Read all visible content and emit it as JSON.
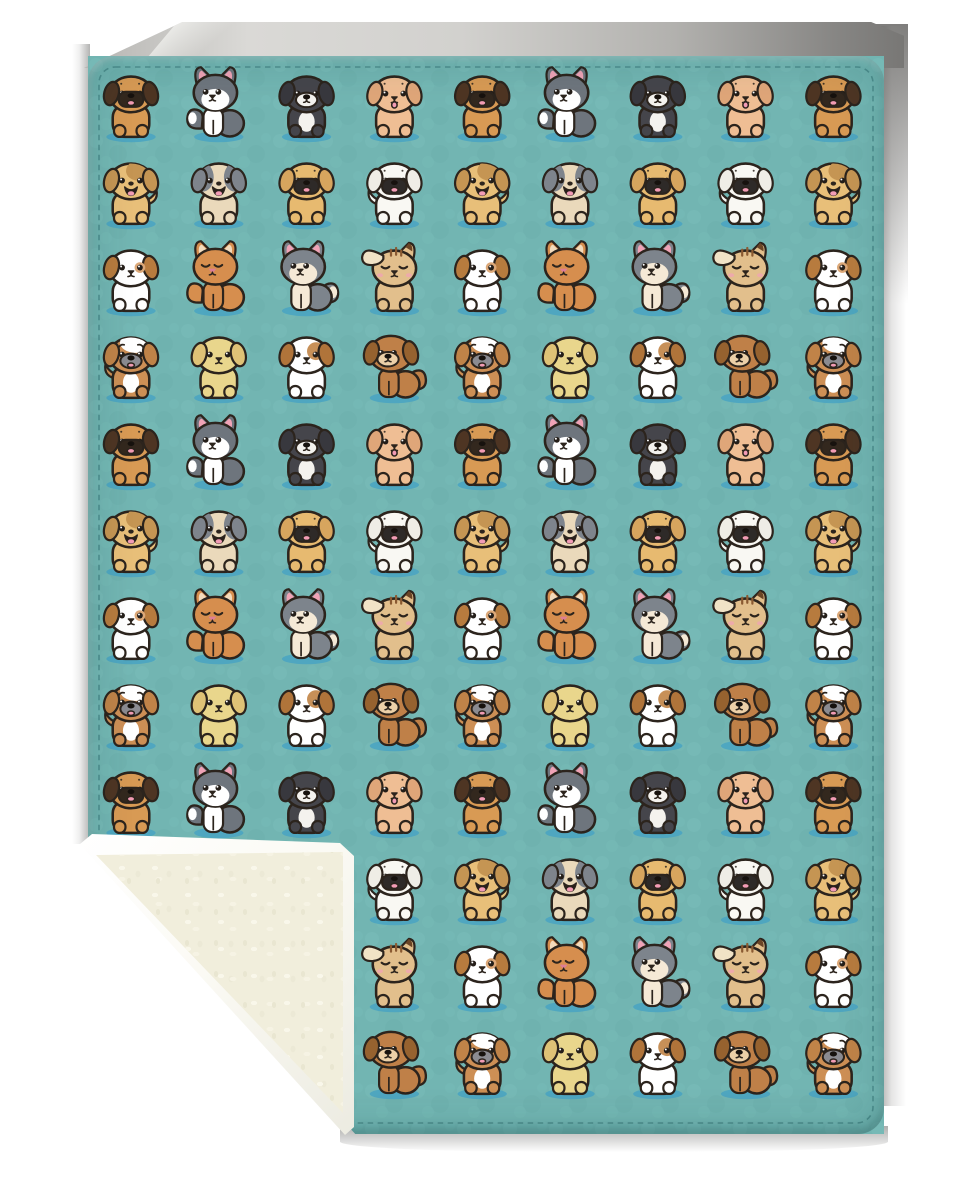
{
  "scene": {
    "type": "product-photo-mockup",
    "subject": "Teal sherpa fleece blanket covered in rows of cute cartoon puppies, bottom-left corner folded up to show the cream sherpa back",
    "front_fabric": "teal minky printed with kawaii puppy pattern",
    "back_fabric": "cream sherpa fleece with white edge binding",
    "background": "white studio backdrop with soft gray shadows"
  },
  "colors": {
    "outline": "#2c241d",
    "blanket_teal": "#72b5b2",
    "teal_light": "#7ec1bd",
    "teal_dark": "#66aaa7",
    "spot_shadow": "#46a2c3",
    "stitch": "#2e6b6e",
    "sherpa_cream": "#f1eedc",
    "binding_white": "#fdfdfb",
    "backdrop_light": "#d8d7d4",
    "backdrop_mid": "#b3b2af",
    "backdrop_dark": "#7b7a78",
    "tongue_pink": "#f29cb5",
    "ear_pink": "#f0a3b6"
  },
  "pattern": {
    "columns": 9,
    "rows": 12,
    "row_cycle": [
      "A",
      "B",
      "C",
      "D"
    ],
    "type_sequences": {
      "A": [
        "pug-brown",
        "husky-gray",
        "puppy-black",
        "puppy-cream"
      ],
      "B": [
        "patch-smile",
        "sheepdog",
        "pug-tan",
        "pug-white"
      ],
      "C": [
        "jack-russell",
        "kitten-orange",
        "husky-kitten",
        "chihuahua-tan"
      ],
      "D": [
        "bulldog",
        "lab-yellow",
        "spotted-white",
        "puppy-brown-sit"
      ]
    }
  },
  "dog_types": {
    "pug-brown": {
      "label": "brown pug puppy",
      "pose": "front",
      "tail": null,
      "body": "#d89a54",
      "ear": {
        "style": "floppy",
        "color": "#4e3523"
      },
      "muzzle": {
        "style": "mask",
        "color": "#33281e",
        "tongue": true
      },
      "eyes": "open",
      "brows": "dots"
    },
    "husky-gray": {
      "label": "gray husky puppy sitting sideways",
      "pose": "side",
      "tail": "left",
      "tail_tip": "#ffffff",
      "body": "#6e757d",
      "leg_color": "#ffffff",
      "ear": {
        "style": "pointy",
        "color": "#6e757d",
        "inner": "#f0a3b6"
      },
      "blaze": "#ffffff",
      "muzzle": {
        "style": "simple",
        "tongue": false
      },
      "eyes": "open",
      "brows": "none"
    },
    "puppy-black": {
      "label": "black puppy with white muzzle",
      "pose": "front",
      "tail": null,
      "body": "#45454b",
      "ear": {
        "style": "floppy",
        "color": "#38383e"
      },
      "chest": "#f4f2ee",
      "muzzle": {
        "style": "oval",
        "color": "#f4f2ee",
        "tongue": false
      },
      "eyes": "open",
      "brows": "none"
    },
    "puppy-cream": {
      "label": "cream puppy with tongue out",
      "pose": "front",
      "tail": null,
      "body": "#efbe94",
      "ear": {
        "style": "floppy",
        "color": "#dfa679"
      },
      "muzzle": {
        "style": "simple",
        "tongue": true
      },
      "eyes": "open",
      "brows": "dots"
    },
    "patch-smile": {
      "label": "tan puppy with brown patch smiling",
      "pose": "front",
      "tail": "right",
      "body": "#e8bf79",
      "ear": {
        "style": "floppy",
        "color": "#c59553"
      },
      "head_patch": {
        "style": "crown-right",
        "color": "#c59553"
      },
      "muzzle": {
        "style": "open",
        "color": "#2a1f1a",
        "tongue": true
      },
      "eyes": "open",
      "brows": "none"
    },
    "sheepdog": {
      "label": "cream puppy with gray ears",
      "pose": "front",
      "tail": null,
      "body": "#ead9bb",
      "ear": {
        "style": "floppy",
        "color": "#7e848c"
      },
      "head_patch": {
        "style": "side-patches",
        "color": "#7e848c"
      },
      "muzzle": {
        "style": "open",
        "color": "#2a1f1a",
        "tongue": true
      },
      "eyes": "open",
      "brows": "none"
    },
    "pug-tan": {
      "label": "tan pug puppy",
      "pose": "front",
      "tail": null,
      "body": "#e7ba70",
      "ear": {
        "style": "floppy",
        "color": "#d7a55e"
      },
      "muzzle": {
        "style": "mask",
        "color": "#2e2a28",
        "tongue": true
      },
      "eyes": "open",
      "brows": "dots"
    },
    "pug-white": {
      "label": "white pug puppy",
      "pose": "front",
      "tail": "left",
      "body": "#f9f8f3",
      "ear": {
        "style": "floppy",
        "color": "#efede6"
      },
      "muzzle": {
        "style": "mask",
        "color": "#2e2a28",
        "tongue": true
      },
      "eyes": "open",
      "brows": "dots"
    },
    "jack-russell": {
      "label": "white puppy with brown ears",
      "pose": "front",
      "tail": null,
      "body": "#ffffff",
      "ear": {
        "style": "floppy",
        "color": "#b77b3e"
      },
      "eye_ring": "#dca878",
      "muzzle": {
        "style": "simple",
        "tongue": false
      },
      "eyes": "open",
      "brows": "none"
    },
    "kitten-orange": {
      "label": "sleepy orange puppy with curled tail",
      "pose": "side",
      "tail": "left",
      "body": "#d68e4e",
      "ear": {
        "style": "pointy",
        "color": "#d68e4e",
        "inner": "#f3dbbc"
      },
      "muzzle": {
        "style": "simple",
        "nose": "#dd7e95",
        "tongue": false
      },
      "eyes": "closed",
      "brows": "none"
    },
    "husky-kitten": {
      "label": "gray puppy with white-tipped tail",
      "pose": "side",
      "tail": "right",
      "tail_tip": "#f5e9d6",
      "body": "#7d848c",
      "leg_color": "#f5e9d6",
      "ear": {
        "style": "pointy",
        "color": "#7d848c",
        "inner": "#f0a3b6"
      },
      "blaze": "#f5e9d6",
      "muzzle": {
        "style": "simple",
        "tongue": false
      },
      "eyes": "open",
      "brows": "none"
    },
    "chihuahua-tan": {
      "label": "sleepy tan chihuahua with blush",
      "pose": "front",
      "tail": null,
      "body": "#e2bf8c",
      "ear": {
        "style": "chihuahua",
        "color": "#f1e3c6",
        "tip": "#6b4526"
      },
      "stripes": "#8a5a32",
      "muzzle": {
        "style": "simple",
        "tongue": false
      },
      "eyes": "closed",
      "blush": "#f0a3b6",
      "brows": "none"
    },
    "bulldog": {
      "label": "worried bulldog puppy",
      "pose": "front",
      "tail": "left",
      "body": "#cd8f55",
      "ear": {
        "style": "floppy",
        "color": "#c08348"
      },
      "head_patch": {
        "style": "crown-white",
        "color": "#ffffff"
      },
      "chest": "#ffffff",
      "muzzle": {
        "style": "oval",
        "color": "#8b8b91",
        "tongue": true
      },
      "eyes": "open",
      "brows": "worried"
    },
    "lab-yellow": {
      "label": "yellow lab puppy",
      "pose": "front",
      "tail": null,
      "body": "#e9d68c",
      "ear": {
        "style": "floppy",
        "color": "#dfc276"
      },
      "muzzle": {
        "style": "simple",
        "tongue": false
      },
      "eyes": "open",
      "brows": "none"
    },
    "spotted-white": {
      "label": "white puppy with brown eye patch",
      "pose": "front",
      "tail": null,
      "body": "#ffffff",
      "ear": {
        "style": "floppy",
        "color": "#b0743a"
      },
      "head_patch": {
        "style": "eye-right",
        "color": "#c79058"
      },
      "muzzle": {
        "style": "simple",
        "tongue": false
      },
      "eyes": "open",
      "brows": "none"
    },
    "puppy-brown-sit": {
      "label": "brown puppy sitting sideways",
      "pose": "side",
      "tail": "right",
      "body": "#bf8048",
      "ear": {
        "style": "floppy",
        "color": "#96622f"
      },
      "muzzle": {
        "style": "oval",
        "color": "#ecd0a8",
        "tongue": false
      },
      "eyes": "open",
      "brows": "none"
    }
  }
}
